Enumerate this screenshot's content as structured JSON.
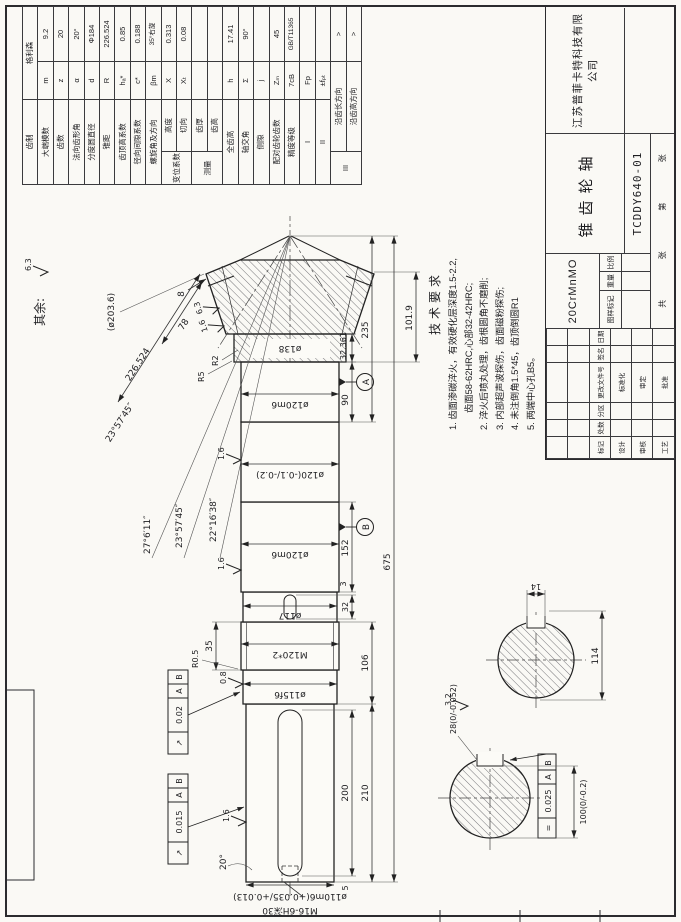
{
  "note": {
    "label": "其余:",
    "value": "6.3"
  },
  "gear_table": {
    "rows": [
      {
        "n": "齿制",
        "s": "",
        "v": "格利森"
      },
      {
        "n": "大端模数",
        "s": "m",
        "v": "9.2"
      },
      {
        "n": "齿数",
        "s": "z",
        "v": "20"
      },
      {
        "n": "法向齿形角",
        "s": "α",
        "v": "20°"
      },
      {
        "n": "分度圆直径",
        "s": "d",
        "v": "Φ184"
      },
      {
        "n": "锥距",
        "s": "R",
        "v": "226.524"
      },
      {
        "n": "齿顶高系数",
        "s": "hₐ*",
        "v": "0.85"
      },
      {
        "n": "径向间隙系数",
        "s": "c*",
        "v": "0.188"
      },
      {
        "n": "螺旋角及方向",
        "s": "βm",
        "v": "35°右旋"
      },
      {
        "g": "变位系数",
        "n": "高度",
        "s": "X",
        "v": "0.313"
      },
      {
        "n": "切向",
        "s": "Xₜ",
        "v": "0.08"
      },
      {
        "g": "测量",
        "n": "齿厚",
        "s": "",
        "v": ""
      },
      {
        "n": "齿高",
        "s": "",
        "v": ""
      },
      {
        "n": "全齿高",
        "s": "h",
        "v": "17.41"
      },
      {
        "n": "轴交角",
        "s": "Σ",
        "v": "90°"
      },
      {
        "n": "侧隙",
        "s": "j",
        "v": ""
      },
      {
        "n": "配对齿轮齿数",
        "s": "Zₘ",
        "v": "45"
      },
      {
        "n": "精度等级",
        "s": "7cB",
        "v": "GB/T11365"
      },
      {
        "n": "I",
        "s": "Fp",
        "v": ""
      },
      {
        "n": "II",
        "s": "±fₚₜ",
        "v": ""
      },
      {
        "g": "III",
        "n": "沿齿长方向",
        "s": "",
        "v": ">"
      },
      {
        "n": "沿齿高方向",
        "s": "",
        "v": ">"
      }
    ]
  },
  "tech_req": {
    "title": "技术要求",
    "lines": [
      "1. 齿面渗碳淬火，有效硬化层深度1.5-2.2,",
      "齿面58-62HRC,心部32-42HRC;",
      "2. 淬火后喷丸处理，齿根圆角不磨削;",
      "3. 内部超声波探伤，齿面磁粉探伤;",
      "4. 未注倒角1.5*45，齿顶倒圆R1",
      "5. 两端中心孔B5。"
    ]
  },
  "title_block": {
    "company": "江苏普菲卡特科技有限公司",
    "part_name": "锥齿轮轴",
    "drawing_no": "TCDDY640-01",
    "material": "20CrMnMO",
    "sig": {
      "h0": "标记",
      "h1": "处数",
      "h2": "分区",
      "h3": "更改文件号",
      "h4": "签名",
      "h5": "日期",
      "r1c1": "设计",
      "r1c4": "标准化",
      "r2c1": "审核",
      "r2c4": "审定",
      "r3c1": "工艺",
      "r3c4": "批准"
    },
    "mark": {
      "m0": "图样标记",
      "m1": "重量",
      "m2": "比例"
    },
    "sheet": {
      "s0": "共",
      "s1": "张",
      "s2": "第",
      "s3": "张"
    }
  },
  "drawing": {
    "dims": {
      "d675": "675",
      "d235": "235",
      "d210": "210",
      "d200": "200",
      "d152": "152",
      "d106": "106",
      "d101_9": "101.9",
      "d90": "90",
      "d32_361": "32.361",
      "d35": "35",
      "d32": "32",
      "d14": "14",
      "d114": "114",
      "d8": "8",
      "d5": "5",
      "d3": "3",
      "d78": "78",
      "cone_dist": "226.524",
      "dia110": "ø110m6(+0.035/+0.013)",
      "dia115": "ø115f6",
      "thread": "M120*2",
      "dia117": "ø117",
      "dia120m6": "ø120m6",
      "dia120tol": "ø120(-0.1/-0.2)",
      "dia138": "ø138",
      "dia203": "(ø203.6)",
      "key28": "28(0/-0.052)",
      "len100": "100(0/-0.2)",
      "center_hole": "M16-6H深30",
      "ang1": "27°6′11″",
      "ang2": "23°57′45″",
      "ang3": "22°16′38″",
      "ang_cone": "23°57′45″",
      "ang20": "20°",
      "r05": "R0.5",
      "r5": "R5",
      "r2": "R2"
    },
    "rough": {
      "v16": "1.6",
      "v08": "0.8",
      "v32": "3.2",
      "v63": "6.3"
    },
    "gdt": {
      "runout_symbol": "↗",
      "sym_symbol": "=",
      "runout1": "0.02",
      "runout2": "0.015",
      "symmetry": "0.025",
      "ref_a": "A",
      "ref_b": "B"
    },
    "datums": {
      "a": "A",
      "b": "B"
    }
  }
}
